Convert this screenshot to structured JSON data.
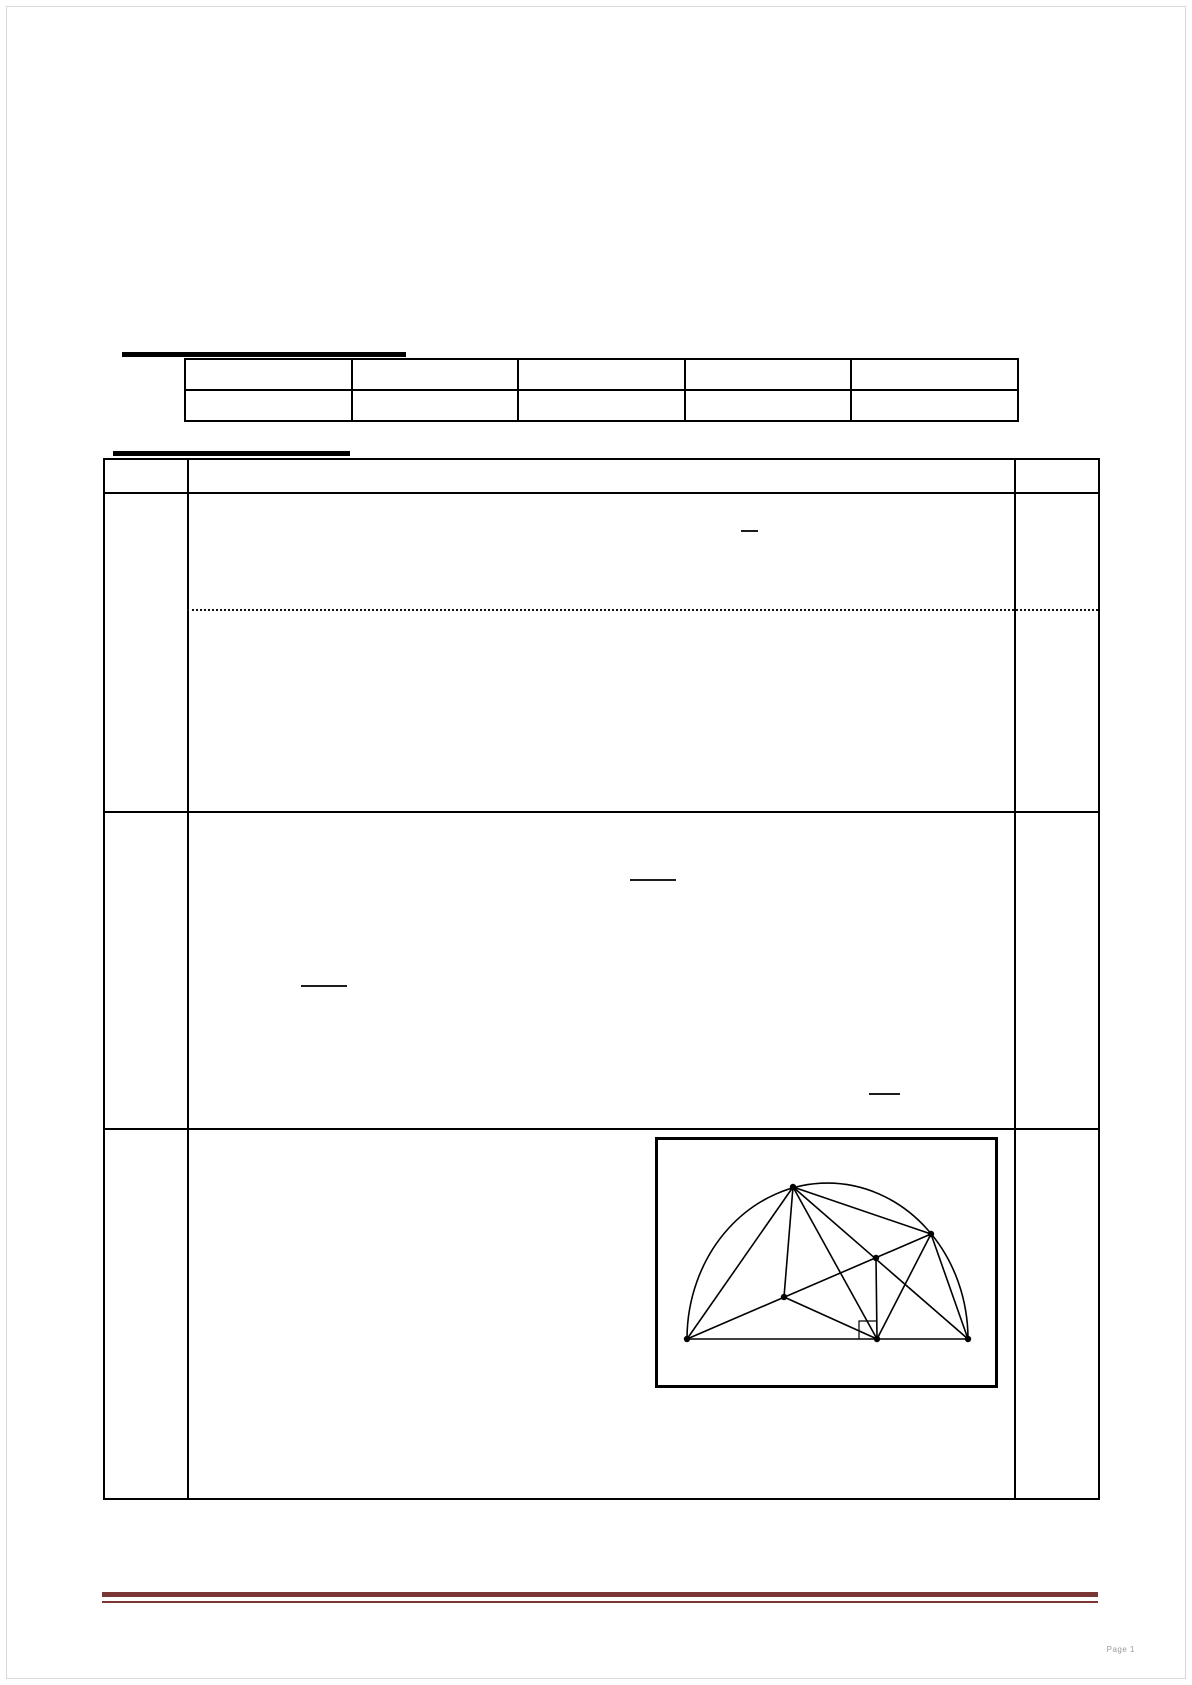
{
  "page": {
    "footer_text": "Page 1"
  },
  "colors": {
    "footer_rule": "#7b3535",
    "line": "#000000"
  },
  "heading_bars": [
    {
      "name": "top-heading-underline",
      "x": 122,
      "y": 352,
      "w": 284,
      "h": 5
    },
    {
      "name": "tasks-heading-underline",
      "x": 113,
      "y": 451,
      "w": 237,
      "h": 5
    }
  ],
  "grade_table": {
    "rows": 2,
    "columns": 5
  },
  "task_table": {
    "columns": 3,
    "header_row": {
      "cells": [
        "",
        "",
        ""
      ]
    },
    "body_rows": 3,
    "dotted_separator_row": 1
  },
  "redactions": {
    "fraction_bars": [
      {
        "x": 741,
        "y": 530,
        "w": 17
      },
      {
        "x": 630,
        "y": 879,
        "w": 46
      },
      {
        "x": 301,
        "y": 985,
        "w": 46
      },
      {
        "x": 869,
        "y": 1093,
        "w": 31
      }
    ]
  },
  "figure": {
    "box": {
      "x": 657,
      "y": 1139,
      "w": 341,
      "h": 249
    },
    "points": {
      "A": [
        687,
        1339
      ],
      "B": [
        877,
        1339
      ],
      "C": [
        968,
        1339
      ],
      "D": [
        793,
        1187
      ],
      "E": [
        931,
        1234
      ],
      "F": [
        876,
        1258
      ],
      "G": [
        784,
        1297
      ]
    },
    "semicircle": {
      "from": "A",
      "to": "C",
      "rx": 140.5,
      "ry": 156
    },
    "segments": [
      [
        "A",
        "C"
      ],
      [
        "A",
        "E"
      ],
      [
        "A",
        "D"
      ],
      [
        "D",
        "G"
      ],
      [
        "D",
        "B"
      ],
      [
        "D",
        "E"
      ],
      [
        "D",
        "C"
      ],
      [
        "E",
        "B"
      ],
      [
        "E",
        "C"
      ],
      [
        "G",
        "B"
      ],
      [
        "F",
        "B"
      ]
    ],
    "right_angle_marker": {
      "polyline": [
        [
          859,
          1339
        ],
        [
          859,
          1321
        ],
        [
          877,
          1321
        ]
      ]
    },
    "dot_radius": 3.2
  }
}
